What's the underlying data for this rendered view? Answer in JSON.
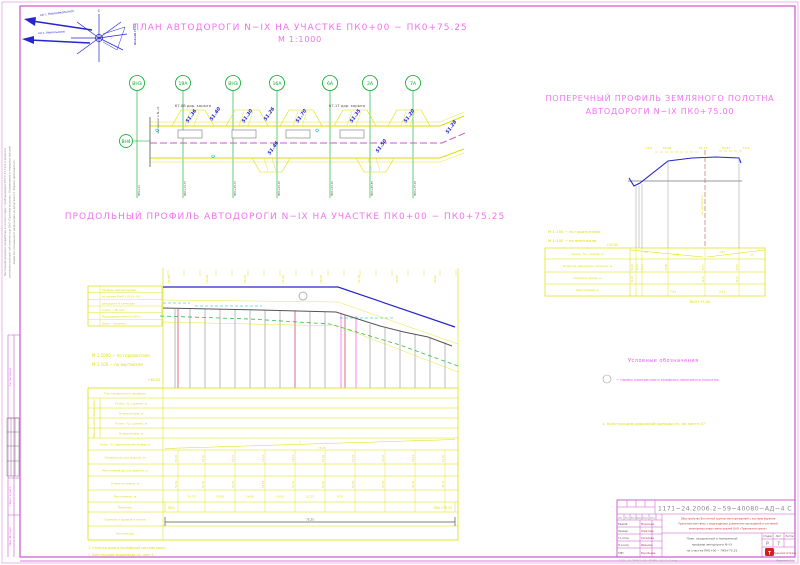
{
  "titles": {
    "plan": "ПЛАН АВТОДОРОГИ N−IX НА УЧАСТКЕ ПК0+00 − ПК0+75.25",
    "plan_scale": "М 1:1000",
    "profile": "ПРОДОЛЬНЫЙ ПРОФИЛЬ АВТОДОРОГИ N−IX НА УЧАСТКЕ ПК0+00 − ПК0+75.25",
    "cross1": "ПОПЕРЕЧНЫЙ ПРОФИЛЬ ЗЕМЛЯНОГО ПОЛОТНА",
    "cross2": "АВТОДОРОГИ N−IX  ПК0+75.00"
  },
  "windrose": {
    "dir1": "на с. Новоникольское",
    "dir2": "на с. Никольское",
    "caption": "РОЗА ВЕТРОВ",
    "north": "С"
  },
  "plan": {
    "pickets": [
      {
        "label": "ВН3"
      },
      {
        "label": "19А"
      },
      {
        "label": "ВН3"
      },
      {
        "label": "16А"
      },
      {
        "label": "6А"
      },
      {
        "label": "2А"
      },
      {
        "label": "7А"
      }
    ],
    "left_picket": "ВН4",
    "axis_label": "автодорога N−IX",
    "dims": [
      "67.88 дор. корыто",
      "67.17 дор. корыто"
    ],
    "elevations": [
      "51.36",
      "51.40",
      "51.30",
      "51.26",
      "51.70",
      "51.35",
      "51.20",
      "51.46",
      "51.50",
      "51.28"
    ],
    "stations": [
      "ПК0+00",
      "ПК0+13.70",
      "ПК0+28.70",
      "ПК0+43.30",
      "ПК0+53.30",
      "ПК0+65.55",
      "ПК0+75.25"
    ]
  },
  "long_profile": {
    "scale_h": "М 1:1000 − по горизонтали",
    "scale_v": "М 1:100 − по вертикали",
    "datum": "+48.00",
    "note_box": [
      "Профиль запроектирован",
      "по нормам СНиП 2.05.02−85",
      "для дороги IV категории",
      "V расч. = 80 км/ч",
      "Руководящая отметка 0.65 м",
      "Грунт − суглинок"
    ],
    "top_elevations": [
      "53.30",
      "53.28",
      "53.25",
      "53.20",
      "53.05",
      "52.70",
      "52.35",
      "52.00"
    ],
    "rows": {
      "r1": "Тип поперечного профиля",
      "g1": "Левый кювет",
      "g2": "Правый кювет",
      "r2": "Уклон, ‰ / длина, м",
      "r3": "Отметка дна, м",
      "r4": "Уклон, ‰ / длина, м",
      "r5": "Отметка дна, м",
      "r6": "Уклон, ‰ / вертикальная кривая, м",
      "r7": "Отметка по оси дороги, м",
      "r8": "Расстояние до оси дороги, м",
      "r9": "Отметка земли, м",
      "r10": "Расстояние, м",
      "r11": "Пикетаж",
      "r12": "Прямые и кривые в плане",
      "r13": "Километры"
    },
    "slope": "7",
    "length": "75.25",
    "axis_marks": [
      "53.30",
      "53.30",
      "53.27",
      "53.22",
      "53.10",
      "52.90",
      "52.65",
      "52.40",
      "52.15",
      "51.90"
    ],
    "ground_marks": [
      "51.32",
      "51.30",
      "51.26",
      "51.18",
      "51.02",
      "50.80",
      "50.55",
      "50.28",
      "50.02",
      "49.75"
    ],
    "distances": [
      "13.70",
      "15.00",
      "14.60",
      "10.00",
      "12.25",
      "9.70"
    ],
    "picket_start": "ПК0",
    "picket_end": "ПК0+75.25",
    "plan_length": "75.25",
    "notes": [
      "1. Отметки даны в Балтийской системе высот.",
      "2. Конструкцию водоотвода см. лист 5."
    ]
  },
  "cross_section": {
    "scale_h": "М 1:100 − по горизонтали",
    "scale_v": "М 1:100 − по вертикали",
    "datum": "+52.00",
    "top_marks": [
      "53.0",
      "53.88",
      "53.77",
      "53.87",
      "53.4"
    ],
    "axis_text": "ось автодороги",
    "rows": [
      "Уклон, ‰ / длина, м",
      "Отметка земляного полотна, м",
      "Отметка земли, м",
      "Расстояние, м"
    ],
    "slope_values": [
      "20",
      "2.58",
      "7.67",
      "20"
    ],
    "design_marks": [
      "52.10",
      "52.12",
      "52.14",
      "53.88",
      "53.77",
      "53.87"
    ],
    "ground_marks": [
      "52.10",
      "52.12",
      "52.14"
    ],
    "distances": [
      "7.63",
      "3.63"
    ],
    "picket": "ПК0+75.00"
  },
  "legend": {
    "heading": "Условные обозначения",
    "item": "− номер поперечного профиля земляного полотна",
    "note": "1. Конструкцию дорожной одежды см. на листе 07"
  },
  "stamp": {
    "doc_number": "1171−24.2006.2−59−40080−АД−4 С",
    "org1": "Обустройство Восточной группы месторождений с кустами бурения",
    "org2": "Транспортная связь с подъездными узлами месторождений и системой",
    "org3": "межпромысловых магистралей ОАО «Трансмагистраль»",
    "sig_headers": [
      "Изм.",
      "Кол.",
      "Лист",
      "№док",
      "Подп.",
      "Дата"
    ],
    "sig_rows": [
      {
        "role": "Разраб.",
        "name": "Морозова"
      },
      {
        "role": "Провер.",
        "name": "Юматова"
      },
      {
        "role": "Гл.спец.",
        "name": "Киселева"
      },
      {
        "role": "Н.контр.",
        "name": "Иванова"
      },
      {
        "role": "ГИП",
        "name": "Воробьева"
      }
    ],
    "name1": "План, продольный и поперечный",
    "name2": "профили автодороги N−IX",
    "name3": "на участке ПК0+00 − ПК0+75.25",
    "stage_headers": [
      "Стадия",
      "Лист",
      "Листов"
    ],
    "stage": "Р",
    "sheet": "7",
    "sheets": "",
    "company": "Трансмагистраль",
    "logo": "Т",
    "format": "Формат А1",
    "file": "1171−24.2006.2−59−40080−АД−4−С.dwg"
  },
  "margins": {
    "note1": "Настоящий документ разработан в соответствии с требованиями ГОСТ Р 21.1101 и является",
    "note2": "интеллектуальной собственностью ОАО «Трансмагистраль». Копирование и передача третьим",
    "note3": "лицам без письменного разрешения не допускается. Формат оригинала А1.",
    "soglasovano": "Согласовано",
    "podp_data": "Подп. и дата",
    "inv_podl": "Инв. № подл."
  }
}
